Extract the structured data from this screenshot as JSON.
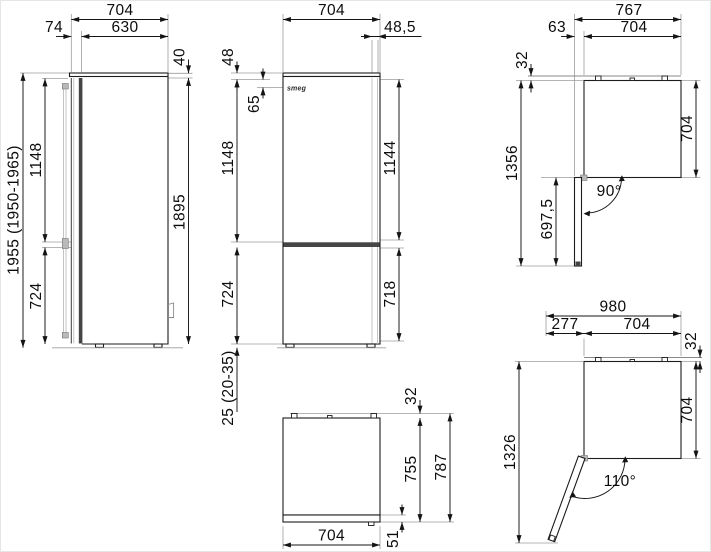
{
  "canvas": {
    "background": "#ffffff",
    "border_color": "#e5e5e5",
    "line_color": "#1c1c1c",
    "extension_line_color": "#9c9c9c"
  },
  "brand": {
    "logo_text": "smeg"
  },
  "views": {
    "side": {
      "dims": {
        "total_depth": "704",
        "door_depth": "74",
        "cabinet_depth": "630",
        "top_cover": "40",
        "upper_section": "1148",
        "overall_height": "1955 (1950-1965)",
        "lower_section": "724",
        "body_height": "1895"
      }
    },
    "front": {
      "dims": {
        "width": "704",
        "side_panel": "48,5",
        "top_offset": "48",
        "logo_offset": "65",
        "upper_left": "1148",
        "upper_right": "1144",
        "lower_left": "724",
        "lower_right": "718",
        "feet_height": "25 (20-35)"
      }
    },
    "top90": {
      "dims": {
        "total_width": "767",
        "door_offset": "63",
        "width": "704",
        "rear_gap": "32",
        "depth_open": "1356",
        "door_length": "697,5",
        "depth": "704",
        "angle": "90°"
      }
    },
    "topClosed": {
      "dims": {
        "rear_gap": "32",
        "depth_with_door": "755",
        "total_depth": "787",
        "width": "704",
        "door_thickness": "51"
      }
    },
    "top110": {
      "dims": {
        "total_width": "980",
        "door_swing": "277",
        "width": "704",
        "rear_gap": "32",
        "depth": "704",
        "depth_open": "1326",
        "angle": "110°"
      }
    }
  }
}
